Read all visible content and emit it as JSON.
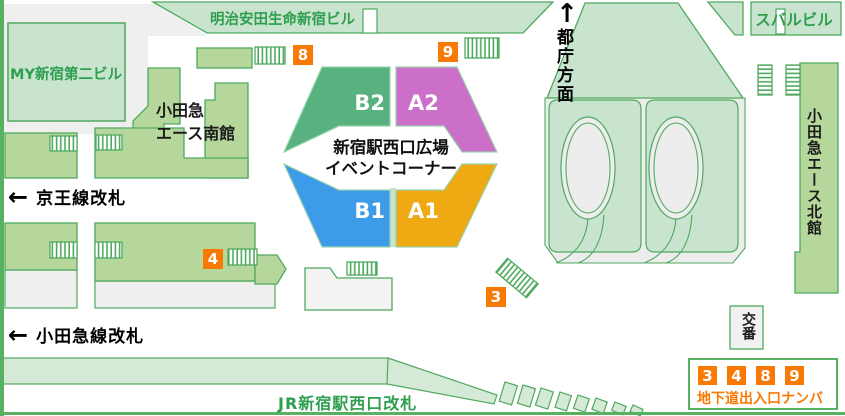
{
  "buildings": {
    "meiji_yasuda": "明治安田生命新宿ビル",
    "subaru": "スバルビル",
    "my_shinjuku_no2": "MY新宿第二ビル",
    "odakyu_ace_south_line1": "小田急",
    "odakyu_ace_south_line2": "エース南館",
    "odakyu_ace_north": "小田急エース北館",
    "koban": "交番"
  },
  "gates": {
    "keio": "京王線改札",
    "odakyu": "小田急線改札",
    "jr": "JR新宿駅西口改札"
  },
  "direction": {
    "tocho": "都庁方面",
    "up_arrow": "↑",
    "left_arrow": "←"
  },
  "event_corner": {
    "title_line1": "新宿駅西口広場",
    "title_line2": "イベントコーナー",
    "zones": [
      {
        "label": "B2",
        "color": "#57B27F"
      },
      {
        "label": "A2",
        "color": "#CC6FC9"
      },
      {
        "label": "B1",
        "color": "#3D9BE9"
      },
      {
        "label": "A1",
        "color": "#EFA912"
      }
    ]
  },
  "exit_numbers": {
    "n8": "8",
    "n9": "9",
    "n4": "4",
    "n3": "3"
  },
  "legend": {
    "numbers": [
      "3",
      "4",
      "8",
      "9"
    ],
    "label": "地下道出入口ナンバー"
  },
  "colors": {
    "accent_orange": "#F87A05",
    "outline_green": "#4FA95F",
    "label_green": "#2E9E4F",
    "pale_green": "#C8E4CE",
    "building_green": "#B6D79B",
    "band_green": "#D4EAD6",
    "border_green": "#58B161",
    "gray": "#EFEFEF"
  }
}
